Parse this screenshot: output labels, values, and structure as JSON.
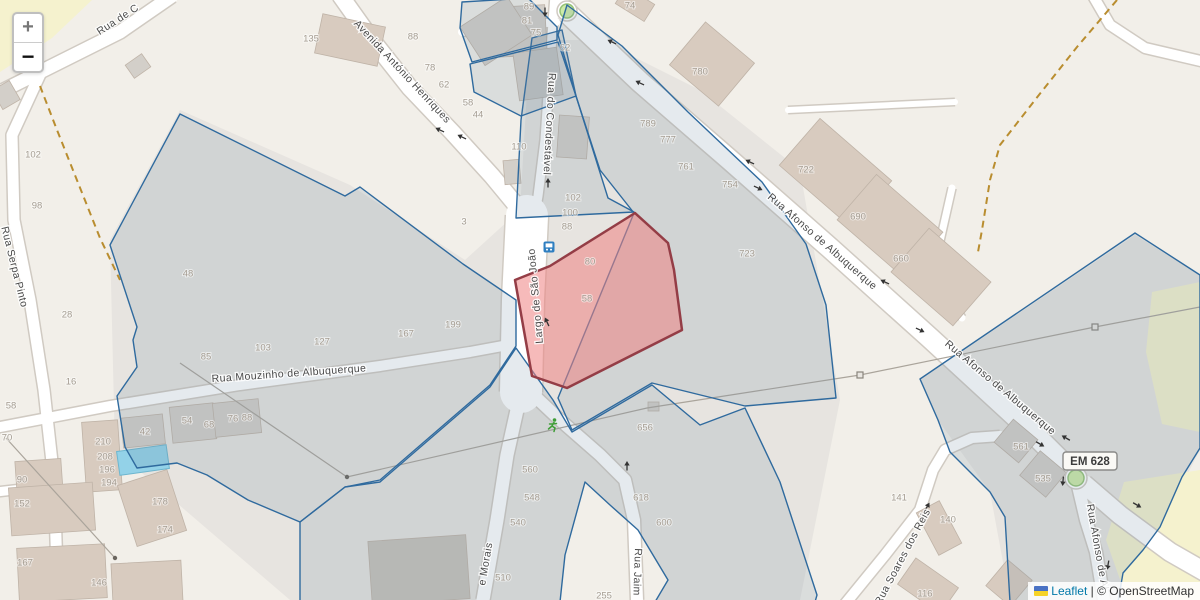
{
  "controls": {
    "zoom_in_label": "+",
    "zoom_out_label": "−"
  },
  "attribution": {
    "library_link": "Leaflet",
    "separator": "|",
    "copyright": "© OpenStreetMap"
  },
  "road_shield_label": "EM 628",
  "colors": {
    "base": "#f2efe9",
    "landuse": "#e7e4e0",
    "grass": "#f5f2ce",
    "road_fill": "#ffffff",
    "road_casing": "#d0cac2",
    "building_tan": "#d8cbbf",
    "building_gray": "#d3cfc9",
    "building_dark": "#c7c2ba",
    "building_stroke": "#bfb3a7",
    "path_dashed": "#b98d2f",
    "power_line": "#aaa49b",
    "parcel_stroke": "#2f6a9e",
    "parcel_fill": "#718ba1",
    "parcel_fill_opacity": 0.18,
    "selected_stroke": "#943d46",
    "selected_fill": "#ee8282",
    "selected_fill_opacity": 0.55,
    "street_text": "#4a4a4a",
    "number_text": "#a59d92",
    "arrow": "#333333",
    "roundabout_fill": "#cdeba8",
    "roundabout_stroke": "#95c277",
    "bus_icon": "#2f7fc1",
    "runner_icon": "#3f9e38",
    "pool_fill": "#93d2e8",
    "pool_stroke": "#6db6cf"
  },
  "streets": [
    {
      "name": "Rua de C",
      "x": 118,
      "y": 20,
      "rot": -33
    },
    {
      "name": "Avenida António Henriques",
      "x": 402,
      "y": 72,
      "rot": 47
    },
    {
      "name": "Rua do Condestável",
      "x": 549,
      "y": 124,
      "rot": 93
    },
    {
      "name": "Rua Afonso de Albuquerque",
      "x": 822,
      "y": 242,
      "rot": 41
    },
    {
      "name": "Rua Afonso de Albuquerque",
      "x": 1000,
      "y": 388,
      "rot": 40
    },
    {
      "name": "Rua Afonso de Al",
      "x": 1097,
      "y": 547,
      "rot": 80
    },
    {
      "name": "Rua Mouzinho de Albuquerque",
      "x": 289,
      "y": 374,
      "rot": -4
    },
    {
      "name": "Rua Serpa Pinto",
      "x": 14,
      "y": 267,
      "rot": 76
    },
    {
      "name": "Largo de São João",
      "x": 536,
      "y": 296,
      "rot": -95
    },
    {
      "name": "e Morais",
      "x": 486,
      "y": 564,
      "rot": -80
    },
    {
      "name": "Rua Jaim",
      "x": 637,
      "y": 572,
      "rot": 92
    },
    {
      "name": "Rua Soares dos Reis",
      "x": 903,
      "y": 557,
      "rot": -62
    }
  ],
  "house_numbers": [
    [
      "135",
      311,
      39
    ],
    [
      "88",
      413,
      37
    ],
    [
      "78",
      430,
      68
    ],
    [
      "62",
      444,
      85
    ],
    [
      "58",
      468,
      103
    ],
    [
      "44",
      478,
      115
    ],
    [
      "110",
      519,
      147
    ],
    [
      "3",
      464,
      222
    ],
    [
      "89",
      529,
      7
    ],
    [
      "81",
      527,
      21
    ],
    [
      "75",
      536,
      33
    ],
    [
      "62",
      565,
      48
    ],
    [
      "74",
      630,
      6
    ],
    [
      "780",
      700,
      72
    ],
    [
      "789",
      648,
      124
    ],
    [
      "777",
      668,
      140
    ],
    [
      "761",
      686,
      167
    ],
    [
      "754",
      730,
      185
    ],
    [
      "723",
      747,
      254
    ],
    [
      "722",
      806,
      170
    ],
    [
      "690",
      858,
      217
    ],
    [
      "660",
      901,
      259
    ],
    [
      "102",
      33,
      155
    ],
    [
      "98",
      37,
      206
    ],
    [
      "48",
      188,
      274
    ],
    [
      "28",
      67,
      315
    ],
    [
      "16",
      71,
      382
    ],
    [
      "58",
      11,
      406
    ],
    [
      "85",
      206,
      357
    ],
    [
      "103",
      263,
      348
    ],
    [
      "127",
      322,
      342
    ],
    [
      "167",
      406,
      334
    ],
    [
      "199",
      453,
      325
    ],
    [
      "102",
      573,
      198
    ],
    [
      "100",
      570,
      213
    ],
    [
      "88",
      567,
      227
    ],
    [
      "80",
      590,
      262
    ],
    [
      "58",
      587,
      299
    ],
    [
      "70",
      7,
      438
    ],
    [
      "42",
      145,
      432
    ],
    [
      "54",
      187,
      421
    ],
    [
      "68",
      209,
      425
    ],
    [
      "76",
      233,
      419
    ],
    [
      "88",
      247,
      418
    ],
    [
      "210",
      103,
      442
    ],
    [
      "208",
      105,
      457
    ],
    [
      "196",
      107,
      470
    ],
    [
      "194",
      109,
      483
    ],
    [
      "90",
      22,
      480
    ],
    [
      "152",
      22,
      504
    ],
    [
      "167",
      25,
      563
    ],
    [
      "146",
      99,
      583
    ],
    [
      "178",
      160,
      502
    ],
    [
      "174",
      165,
      530
    ],
    [
      "560",
      530,
      470
    ],
    [
      "548",
      532,
      498
    ],
    [
      "540",
      518,
      523
    ],
    [
      "510",
      503,
      578
    ],
    [
      "656",
      645,
      428
    ],
    [
      "618",
      641,
      498
    ],
    [
      "600",
      664,
      523
    ],
    [
      "255",
      604,
      596
    ],
    [
      "141",
      899,
      498
    ],
    [
      "140",
      948,
      520
    ],
    [
      "116",
      925,
      594
    ],
    [
      "561",
      1021,
      447
    ],
    [
      "535",
      1043,
      479
    ]
  ],
  "oneway_arrows": [
    [
      440,
      130,
      205
    ],
    [
      462,
      137,
      205
    ],
    [
      545,
      12,
      90
    ],
    [
      612,
      42,
      205
    ],
    [
      640,
      83,
      205
    ],
    [
      750,
      162,
      205
    ],
    [
      758,
      188,
      25
    ],
    [
      885,
      282,
      205
    ],
    [
      920,
      330,
      25
    ],
    [
      548,
      183,
      -90
    ],
    [
      547,
      322,
      -115
    ],
    [
      627,
      466,
      -90
    ],
    [
      927,
      507,
      -60
    ],
    [
      1040,
      444,
      30
    ],
    [
      1066,
      438,
      210
    ],
    [
      1137,
      505,
      30
    ],
    [
      1063,
      481,
      95
    ],
    [
      1108,
      565,
      100
    ]
  ],
  "icons": {
    "bus_stop": [
      549,
      247
    ],
    "runner": [
      553,
      425
    ],
    "road_shield": [
      1090,
      461
    ],
    "roundabouts": [
      [
        567,
        11,
        7
      ],
      [
        1076,
        478,
        8
      ]
    ]
  },
  "geometry": {
    "landuse": [
      [
        [
          110,
          240
        ],
        [
          180,
          110
        ],
        [
          350,
          185
        ],
        [
          465,
          260
        ],
        [
          520,
          210
        ],
        [
          530,
          40
        ],
        [
          600,
          40
        ],
        [
          700,
          90
        ],
        [
          800,
          170
        ],
        [
          840,
          400
        ],
        [
          800,
          600
        ],
        [
          290,
          600
        ],
        [
          115,
          450
        ]
      ],
      [
        [
          920,
          380
        ],
        [
          1135,
          235
        ],
        [
          1200,
          275
        ],
        [
          1200,
          450
        ],
        [
          1160,
          527
        ],
        [
          1118,
          600
        ],
        [
          1010,
          600
        ],
        [
          990,
          492
        ],
        [
          938,
          420
        ]
      ]
    ],
    "beige_patches": [
      [
        [
          585,
          482
        ],
        [
          610,
          505
        ],
        [
          638,
          530
        ],
        [
          668,
          580
        ],
        [
          655,
          602
        ],
        [
          560,
          602
        ],
        [
          565,
          555
        ]
      ]
    ],
    "grass": [
      [
        [
          0,
          0
        ],
        [
          92,
          0
        ],
        [
          52,
          38
        ],
        [
          0,
          72
        ]
      ],
      [
        [
          1152,
          292
        ],
        [
          1200,
          282
        ],
        [
          1200,
          432
        ],
        [
          1162,
          424
        ],
        [
          1146,
          352
        ]
      ],
      [
        [
          1124,
          482
        ],
        [
          1200,
          470
        ],
        [
          1200,
          602
        ],
        [
          1128,
          602
        ],
        [
          1106,
          540
        ]
      ]
    ],
    "paths": [
      [
        [
          40,
          86
        ],
        [
          57,
          130
        ],
        [
          100,
          238
        ],
        [
          120,
          280
        ]
      ],
      [
        [
          1117,
          0
        ],
        [
          1077,
          47
        ],
        [
          1035,
          100
        ],
        [
          1000,
          145
        ],
        [
          990,
          180
        ],
        [
          982,
          230
        ],
        [
          978,
          252
        ]
      ]
    ],
    "roads": [
      {
        "d": "M 172,-4 L 120,32 L 60,62 L 0,92",
        "w": 13
      },
      {
        "d": "M 42,70 L 12,135 L 14,220 L 30,300 L 44,390 L 54,480 L 58,600",
        "w": 11
      },
      {
        "d": "M -4,492 L 48,486",
        "w": 9
      },
      {
        "d": "M 340,-5 L 372,40 L 410,88 L 452,132 L 492,176 L 516,205 L 526,230",
        "w": 16
      },
      {
        "d": "M 555,-5 L 553,22 L 549,80 L 545,140 L 538,196 L 532,230",
        "w": 9
      },
      {
        "d": "M 527,216 L 523,300 L 521,392",
        "w": 42
      },
      {
        "d": "M 521,392 L 507,455 L 497,520 L 483,600",
        "w": 13
      },
      {
        "d": "M 524,386 L 560,420 L 600,455 L 625,480 L 634,520 L 637,600",
        "w": 12
      },
      {
        "d": "M -5,428 L 110,406 L 240,385 L 380,366 L 470,352 L 508,345",
        "w": 10
      },
      {
        "d": "M 560,6 L 640,82 L 730,160 L 830,248 L 930,338 L 1030,430 L 1068,468",
        "w": 20
      },
      {
        "d": "M 1084,484 L 1120,515 L 1170,552 L 1205,572",
        "w": 18
      },
      {
        "d": "M 1078,486 L 1086,520 L 1096,552 L 1104,600",
        "w": 12
      },
      {
        "d": "M 845,604 L 885,555 L 920,510 L 933,470 L 945,450 L 972,438 L 1000,436",
        "w": 10
      },
      {
        "d": "M 1092,-6 L 1110,25 L 1145,48 L 1205,62",
        "w": 10
      },
      {
        "d": "M 462,32 L 556,22",
        "w": 8
      },
      {
        "d": "M 788,110 L 955,102",
        "w": 6
      },
      {
        "d": "M 952,188 L 938,250 L 950,300 L 962,318",
        "w": 7
      }
    ],
    "buildings": [
      [
        318,
        20,
        64,
        40,
        12,
        "t"
      ],
      [
        494,
        6,
        52,
        50,
        -3,
        "g"
      ],
      [
        468,
        8,
        56,
        46,
        -33,
        "g"
      ],
      [
        516,
        50,
        44,
        48,
        -8,
        "g"
      ],
      [
        558,
        116,
        30,
        42,
        4,
        "g"
      ],
      [
        618,
        -6,
        34,
        20,
        32,
        "t"
      ],
      [
        680,
        36,
        64,
        56,
        40,
        "t"
      ],
      [
        788,
        142,
        95,
        62,
        41,
        "t"
      ],
      [
        846,
        196,
        88,
        60,
        41,
        "t"
      ],
      [
        900,
        248,
        82,
        58,
        41,
        "t"
      ],
      [
        504,
        160,
        16,
        24,
        -5,
        "g"
      ],
      [
        122,
        416,
        42,
        30,
        -6,
        "g"
      ],
      [
        171,
        405,
        44,
        36,
        -6,
        "g"
      ],
      [
        214,
        401,
        46,
        34,
        -6,
        "g"
      ],
      [
        84,
        421,
        36,
        70,
        -4,
        "t"
      ],
      [
        16,
        460,
        46,
        34,
        -4,
        "t"
      ],
      [
        10,
        485,
        84,
        48,
        -4,
        "t"
      ],
      [
        18,
        546,
        88,
        54,
        -3,
        "t"
      ],
      [
        126,
        476,
        52,
        64,
        -18,
        "t"
      ],
      [
        112,
        562,
        70,
        42,
        -3,
        "t"
      ],
      [
        370,
        538,
        98,
        64,
        -4,
        "d"
      ],
      [
        926,
        504,
        26,
        48,
        -28,
        "t"
      ],
      [
        902,
        570,
        52,
        32,
        35,
        "t"
      ],
      [
        993,
        566,
        32,
        34,
        40,
        "t"
      ],
      [
        1000,
        426,
        32,
        30,
        40,
        "g"
      ],
      [
        1026,
        458,
        34,
        32,
        40,
        "g"
      ],
      [
        128,
        58,
        20,
        16,
        -35,
        "g"
      ],
      [
        -4,
        84,
        20,
        22,
        -30,
        "g"
      ],
      [
        648,
        402,
        11,
        9,
        0,
        "g"
      ]
    ],
    "pool": [
      118,
      448,
      50,
      24,
      -8
    ],
    "power": {
      "lines": [
        [
          [
            6,
            438
          ],
          [
            115,
            558
          ]
        ],
        [
          [
            180,
            363
          ],
          [
            347,
            477
          ],
          [
            647,
            408
          ],
          [
            860,
            375
          ],
          [
            1095,
            327
          ],
          [
            1200,
            307
          ]
        ]
      ],
      "dots": [
        [
          115,
          558
        ],
        [
          347,
          477
        ]
      ],
      "squares": [
        [
          860,
          375
        ],
        [
          1095,
          327
        ]
      ]
    },
    "parcels": [
      [
        [
          180,
          114
        ],
        [
          345,
          196
        ],
        [
          360,
          187
        ],
        [
          463,
          264
        ],
        [
          516,
          300
        ],
        [
          516,
          346
        ],
        [
          490,
          385
        ],
        [
          380,
          480
        ],
        [
          345,
          487
        ],
        [
          300,
          522
        ],
        [
          248,
          500
        ],
        [
          207,
          475
        ],
        [
          177,
          463
        ],
        [
          137,
          468
        ],
        [
          125,
          447
        ],
        [
          117,
          396
        ],
        [
          137,
          367
        ],
        [
          133,
          340
        ],
        [
          137,
          327
        ],
        [
          110,
          245
        ]
      ],
      [
        [
          532,
          38
        ],
        [
          562,
          30
        ],
        [
          576,
          96
        ],
        [
          608,
          198
        ],
        [
          634,
          212
        ],
        [
          516,
          218
        ],
        [
          521,
          120
        ]
      ],
      [
        [
          462,
          2
        ],
        [
          528,
          -2
        ],
        [
          557,
          27
        ],
        [
          557,
          40
        ],
        [
          472,
          62
        ],
        [
          460,
          28
        ]
      ],
      [
        [
          470,
          64
        ],
        [
          558,
          42
        ],
        [
          576,
          96
        ],
        [
          521,
          116
        ],
        [
          474,
          92
        ]
      ],
      [
        [
          567,
          5
        ],
        [
          622,
          46
        ],
        [
          688,
          112
        ],
        [
          762,
          182
        ],
        [
          806,
          244
        ],
        [
          826,
          305
        ],
        [
          836,
          398
        ],
        [
          745,
          406
        ],
        [
          652,
          383
        ],
        [
          572,
          430
        ],
        [
          558,
          398
        ],
        [
          634,
          213
        ],
        [
          600,
          170
        ],
        [
          576,
          96
        ],
        [
          558,
          35
        ]
      ],
      [
        [
          380,
          482
        ],
        [
          490,
          387
        ],
        [
          516,
          348
        ],
        [
          553,
          400
        ],
        [
          572,
          432
        ],
        [
          652,
          385
        ],
        [
          700,
          425
        ],
        [
          745,
          408
        ],
        [
          780,
          482
        ],
        [
          817,
          595
        ],
        [
          815,
          602
        ],
        [
          655,
          602
        ],
        [
          668,
          580
        ],
        [
          638,
          530
        ],
        [
          610,
          505
        ],
        [
          585,
          482
        ],
        [
          565,
          555
        ],
        [
          560,
          602
        ],
        [
          300,
          602
        ],
        [
          300,
          522
        ],
        [
          345,
          487
        ]
      ],
      [
        [
          1135,
          233
        ],
        [
          1200,
          275
        ],
        [
          1200,
          448
        ],
        [
          1182,
          477
        ],
        [
          1160,
          527
        ],
        [
          1143,
          550
        ],
        [
          1123,
          573
        ],
        [
          1118,
          602
        ],
        [
          1010,
          602
        ],
        [
          1005,
          517
        ],
        [
          990,
          492
        ],
        [
          950,
          452
        ],
        [
          938,
          420
        ],
        [
          920,
          379
        ]
      ]
    ],
    "selected_parcel": [
      [
        635,
        213
      ],
      [
        668,
        243
      ],
      [
        674,
        270
      ],
      [
        682,
        330
      ],
      [
        567,
        388
      ],
      [
        532,
        376
      ],
      [
        515,
        280
      ],
      [
        550,
        266
      ]
    ]
  }
}
